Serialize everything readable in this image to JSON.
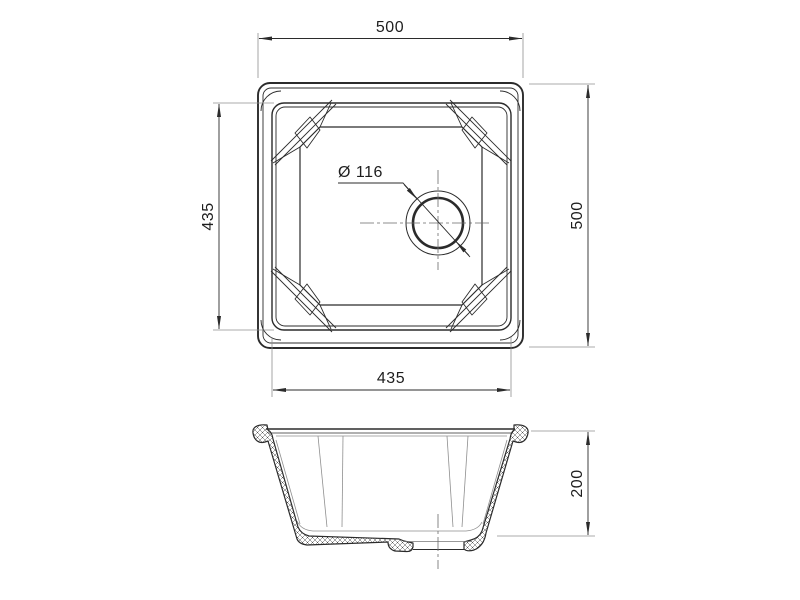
{
  "drawing": {
    "colors": {
      "background": "#ffffff",
      "line": "#2b2b2b",
      "thin_line": "#8f8f8f",
      "centerline": "#6a6a6a",
      "text": "#1e1e1e"
    },
    "dimensions": {
      "overall_width": "500",
      "overall_depth": "500",
      "bowl_inner_depth": "435",
      "bowl_inner_width": "435",
      "drain_diameter": "Ø 116",
      "bowl_height": "200"
    }
  }
}
